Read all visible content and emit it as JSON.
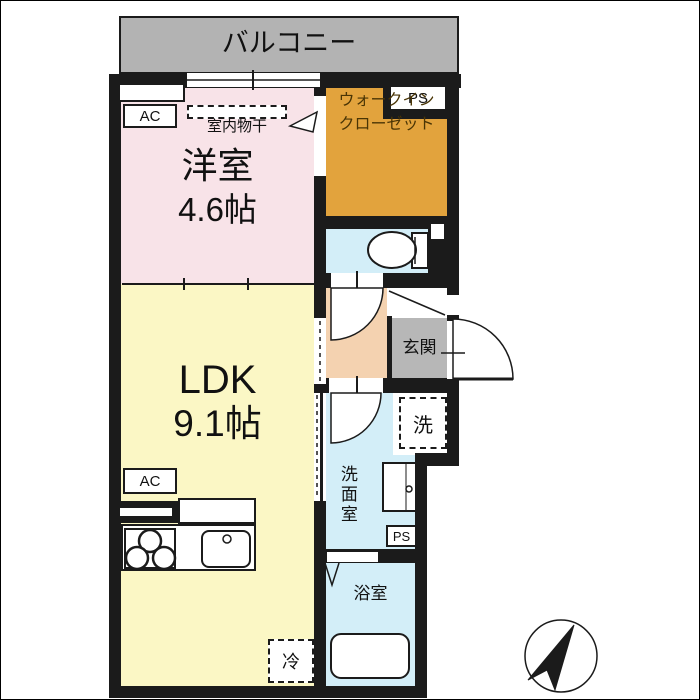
{
  "balcony": {
    "label": "バルコニー"
  },
  "western_room": {
    "name": "洋室",
    "size": "4.6帖"
  },
  "ldk": {
    "name": "LDK",
    "size": "9.1帖"
  },
  "closet": {
    "line1": "ウォークイン",
    "line2": "クローゼット"
  },
  "entrance": {
    "label": "玄関"
  },
  "washroom": {
    "label": "洗面室"
  },
  "bathroom": {
    "label": "浴室"
  },
  "equipment": {
    "ac": "AC",
    "ps": "PS",
    "washer": "洗",
    "fridge": "冷",
    "indoor_drying": "室内物干"
  },
  "colors": {
    "wall": "#1b1b1b",
    "balcony": "#b3b3b3",
    "western_room": "#f8e3e8",
    "ldk": "#fbf7c5",
    "walk_in_closet": "#e2a33d",
    "wet_area": "#d3eef8",
    "hallway": "#f4d2b0",
    "entrance_floor": "#b7b7b7"
  }
}
